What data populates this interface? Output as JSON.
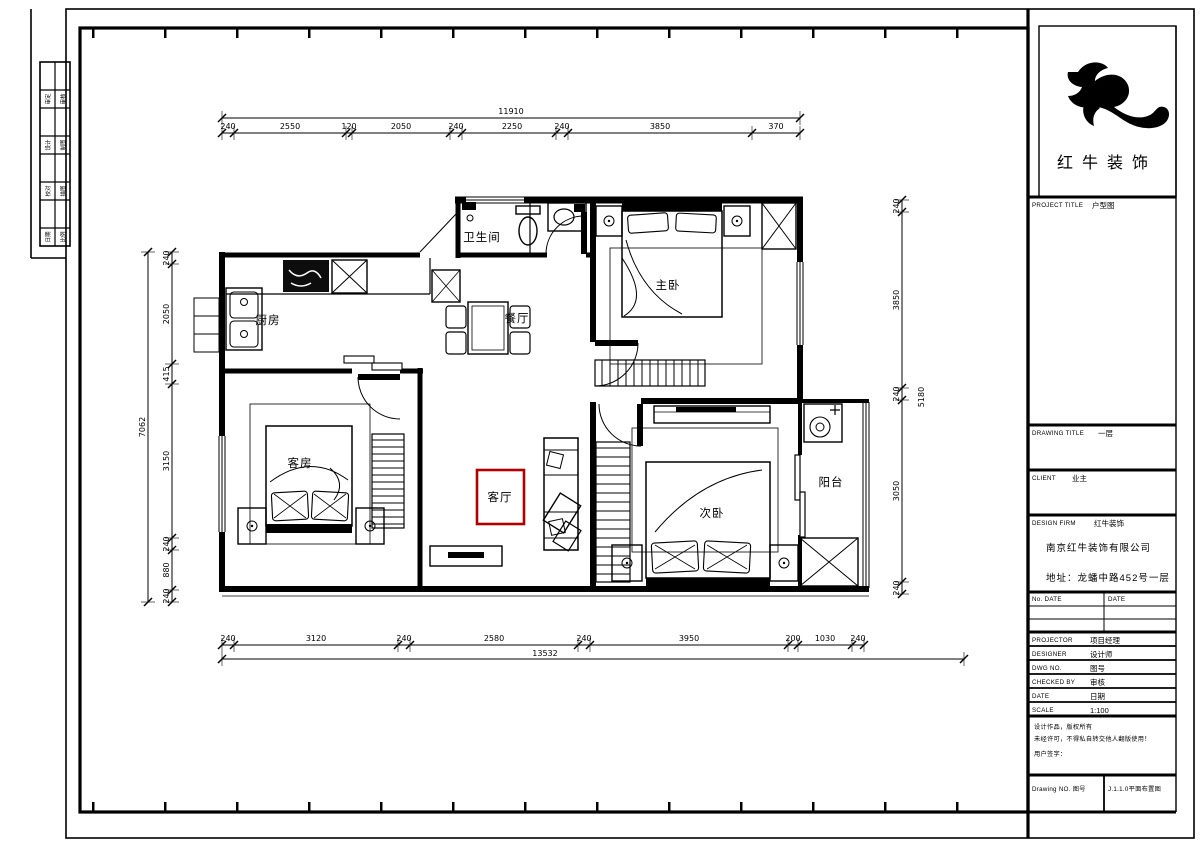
{
  "accent": "#b00000",
  "logo": {
    "brand": "红牛装饰"
  },
  "rooms": {
    "bathroom": "卫生间",
    "master": "主卧",
    "kitchen": "厨房",
    "dining": "餐厅",
    "guest": "客房",
    "living": "客厅",
    "second": "次卧",
    "balcony": "阳台"
  },
  "dims": {
    "top": {
      "overall": "11910",
      "segments": [
        "240",
        "2550",
        "120",
        "2050",
        "240",
        "2250",
        "240",
        "3850",
        "370"
      ]
    },
    "bottom": {
      "overall": "13532",
      "segments": [
        "240",
        "3120",
        "240",
        "2580",
        "240",
        "3950",
        "200",
        "1030",
        "240"
      ]
    },
    "left": {
      "overall": "7062",
      "segments": [
        "240",
        "2050",
        "415",
        "3150",
        "240",
        "880",
        "240"
      ]
    },
    "right": {
      "overall": "5180",
      "segments": [
        "240",
        "3850",
        "240",
        "3050",
        "240"
      ]
    }
  },
  "strip": {
    "labels": [
      "审定",
      "审核",
      "设计",
      "制图",
      "校对",
      "描图",
      "日期",
      "比例"
    ]
  },
  "title_block": {
    "project_title_label": "PROJECT TITLE",
    "project_title_value": "户型图",
    "drawing_title_label": "DRAWING TITLE",
    "drawing_title_value": "一层",
    "client_label": "CLIENT",
    "client_value": "业主",
    "design_firm_label": "DESIGN FIRM",
    "design_firm_value": "红牛装饰",
    "company_line1": "南京红牛装饰有限公司",
    "company_line2": "地址：龙蟠中路452号一层",
    "rev_left": "No. DATE",
    "rev_right": "DATE",
    "rows": [
      {
        "label": "PROJECTOR",
        "value": "项目经理"
      },
      {
        "label": "DESIGNER",
        "value": "设计师"
      },
      {
        "label": "DWG NO.",
        "value": "图号"
      },
      {
        "label": "CHECKED BY",
        "value": "审核"
      },
      {
        "label": "DATE",
        "value": "日期"
      },
      {
        "label": "SCALE",
        "value": "1:100"
      }
    ],
    "note_line1": "设计作品，版权所有",
    "note_line2": "未经许可，不得私自转交他人翻版使用！",
    "note_line3": "用户签字：",
    "bottom_left": "Drawing NO. 图号",
    "bottom_right": "J.1.1.0平面布置图"
  }
}
